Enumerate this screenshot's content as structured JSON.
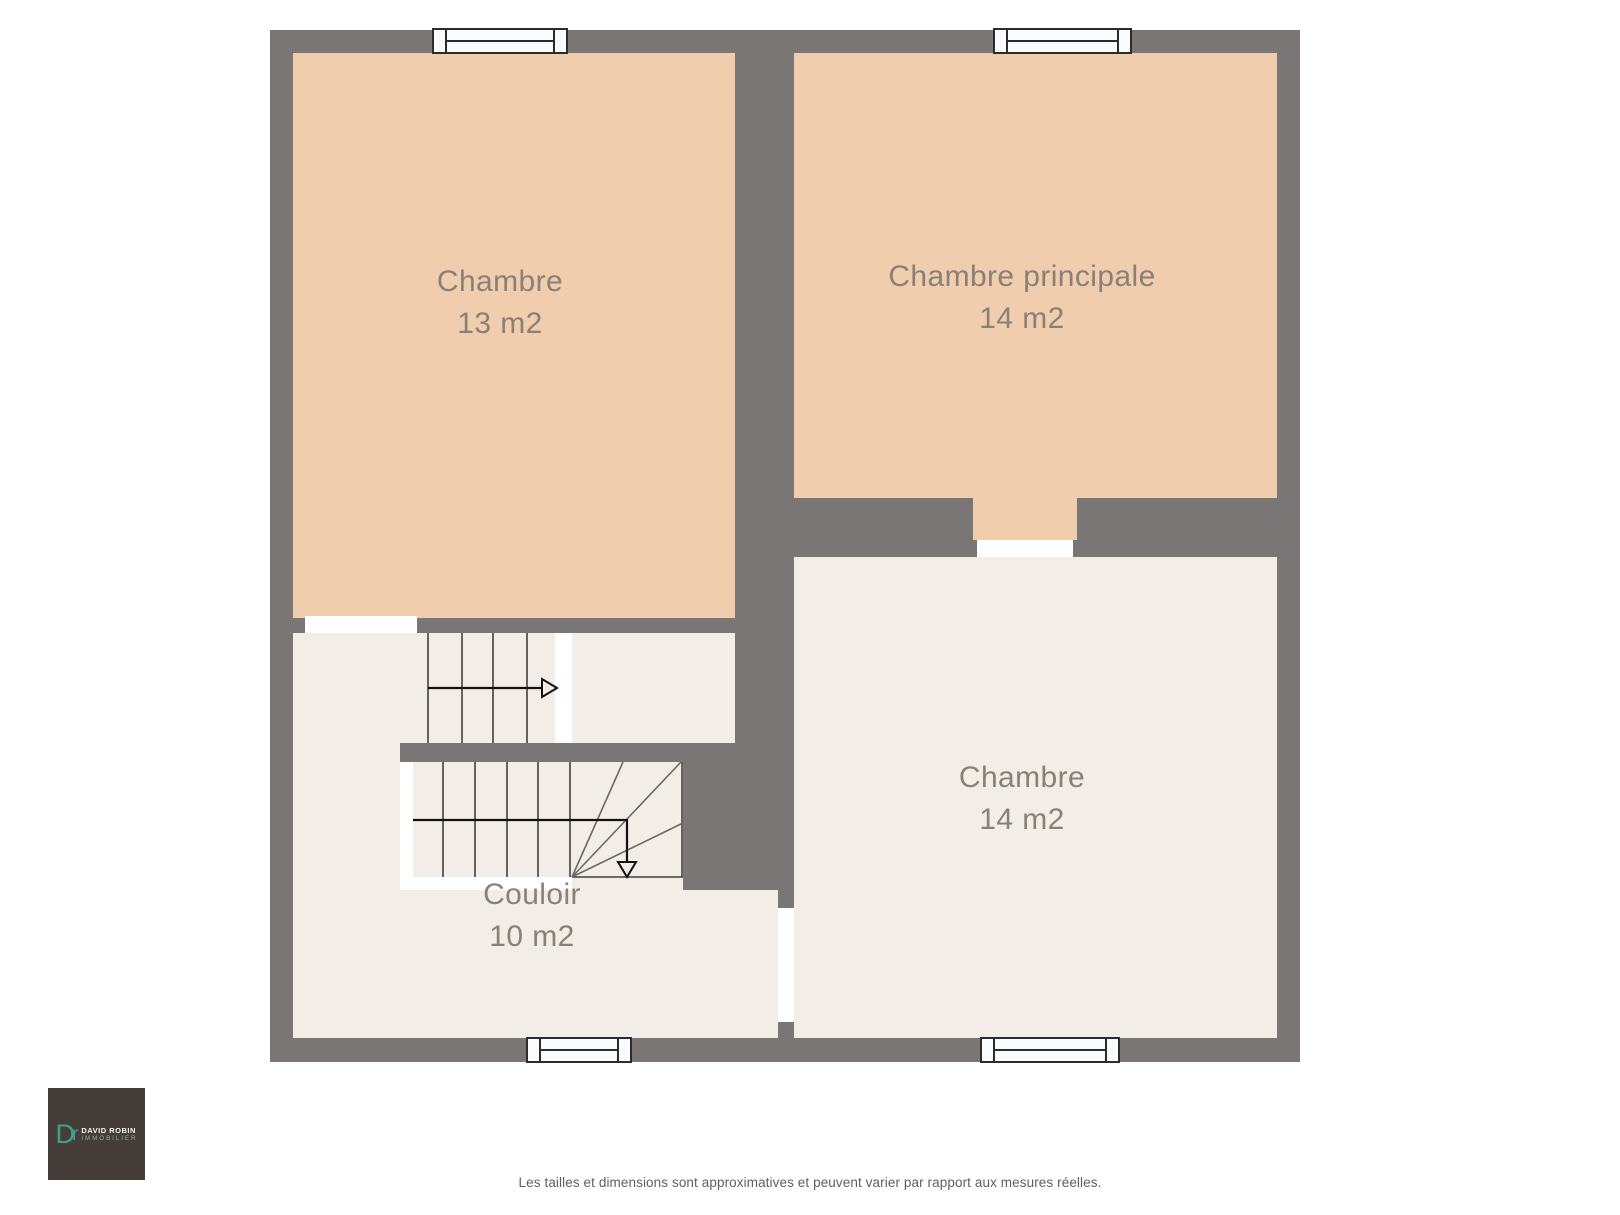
{
  "plan": {
    "rooms": [
      {
        "name": "chambre-1",
        "label": "Chambre",
        "area": "13 m2"
      },
      {
        "name": "chambre-principale",
        "label": "Chambre principale",
        "area": "14 m2"
      },
      {
        "name": "chambre-2",
        "label": "Chambre",
        "area": "14 m2"
      },
      {
        "name": "couloir",
        "label": "Couloir",
        "area": "10 m2"
      }
    ],
    "colors": {
      "wall": "#7a7676",
      "room_warm": "#f0cdad",
      "room_light": "#f2ede6",
      "background": "#ffffff",
      "window_frame": "#2c2c2c",
      "label_text": "#8a8078",
      "arrow": "#111111"
    }
  },
  "logo": {
    "monogram_d": "D",
    "monogram_r": "r",
    "line1": "DAVID ROBIN",
    "line2": "IMMOBILIER"
  },
  "footer": {
    "disclaimer": "Les tailles et dimensions sont approximatives et peuvent varier par rapport aux mesures réelles."
  }
}
